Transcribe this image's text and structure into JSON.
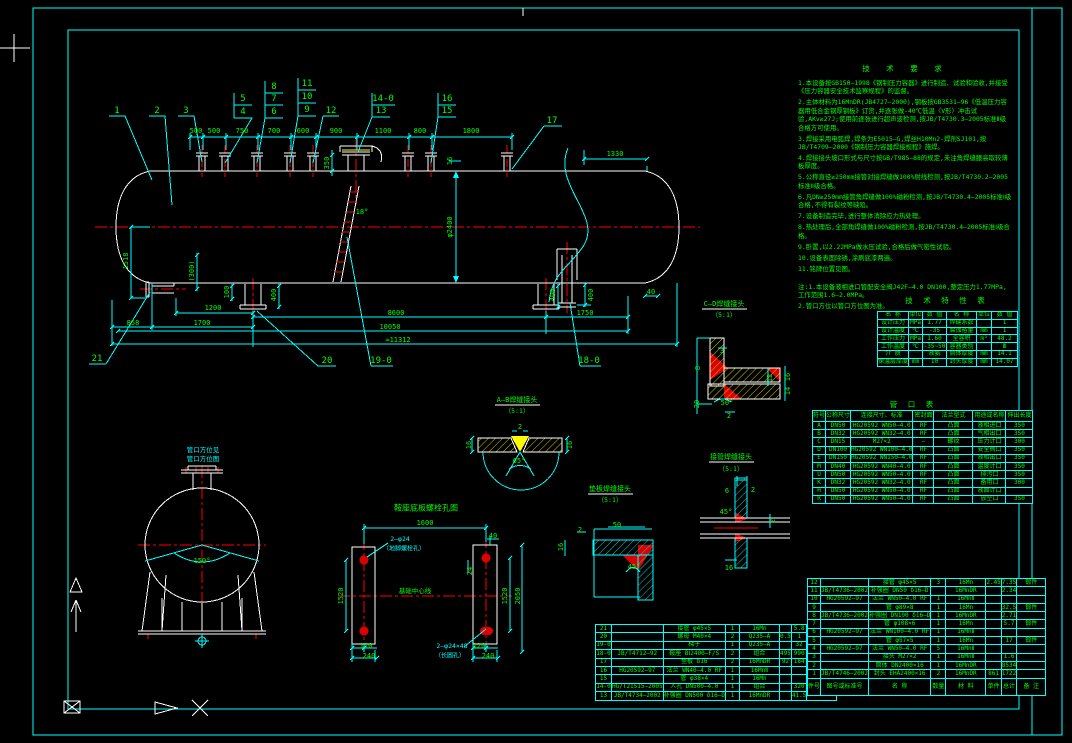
{
  "colors": {
    "background": "#000000",
    "linework": "#ffffff",
    "dims_frame": "#00ffff",
    "text": "#00ff00",
    "centerline": "#ff0000",
    "hatch": "#ffff00"
  },
  "notes": {
    "title": "技 术 要 求",
    "items": [
      "1.本设备按GB150—1998《钢制压力容器》进行制造、试验和验收,并接受《压力容器安全技术监察规程》的监督。",
      "2.主体材料为16MnDR(JB4727—2000),钢板按GB3531—96《低温压力容器用低合金钢厚钢板》订货,并逐张做-40℃低温〈V形〉冲击试验,AKv≥27J;使用前逐张进行超声波检测,按JB/T4730.3—2005标准Ⅱ级合格方可使用。",
      "3.焊接采用电弧焊,焊条为E5015—G,焊丝H10Mn2-焊剂SJ101,按JB/T4709—2000《钢制压力容器焊接规程》施焊。",
      "4.焊接接头坡口形式与尺寸按GB/T985—88的规定,未注角焊缝腰高取较薄板厚度。",
      "5.公称直径≥250mm接管对接焊缝做100%射线检测,按JB/T4730.2—2005标准Ⅱ级合格。",
      "6.凡DN≥250mm接管角焊缝做100%磁粉检测,按JB/T4730.4—2005标准Ⅰ级合格,不得有裂纹等缺陷。",
      "7.设备制造完毕,进行整体消除应力热处理。",
      "8.热处理后,全部角焊缝做100%磁粉检测,按JB/T4730.4—2005标准Ⅰ级合格。",
      "9.卧置,以2.22MPa做水压试验,合格后做气密性试验。",
      "10.设备表面除锈,涂刷底漆两遍。",
      "11.铭牌位置见图。",
      "注:1.本设备液相进口管配安全阀J42F—4.0 DN100,整定压力1.77MPa,工作范围1.6—2.0MPa。",
      "2.管口方位以管口方位图为准。"
    ]
  },
  "tech_table": {
    "title": "技 术 特 性 表",
    "headers": [
      "名 称",
      "单位",
      "数 值",
      "名 称",
      "单位",
      "数 值"
    ],
    "rows": [
      [
        "设计压力",
        "MPa",
        "1.77",
        "焊缝系数",
        "",
        "1"
      ],
      [
        "设计温度",
        "℃",
        "-35",
        "腐蚀裕量",
        "mm",
        "1"
      ],
      [
        "工作压力",
        "MPa",
        "1.60",
        "全容积",
        "m³",
        "48.2"
      ],
      [
        "工作温度",
        "℃",
        "-35~50",
        "容器类别",
        "",
        "Ⅲ"
      ],
      [
        "介 质",
        "",
        "液氨",
        "筒体厚度",
        "mm",
        "14.1"
      ],
      [
        "保温层厚度",
        "mm",
        "10",
        "封头厚度",
        "mm",
        "14.07"
      ]
    ]
  },
  "nozzle_table": {
    "title": "管 口 表",
    "headers": [
      "符号",
      "公称尺寸",
      "连接尺寸、标准",
      "密封面",
      "法兰型式",
      "用途或名称",
      "伸出长度"
    ],
    "rows": [
      [
        "A",
        "DN50",
        "HG20592 WN50—4.0",
        "RF",
        "凸面",
        "液相进口",
        "350"
      ],
      [
        "B",
        "DN32",
        "HG20592 WN32—4.0",
        "RF",
        "凸面",
        "气相出口",
        "350"
      ],
      [
        "C",
        "DN15",
        "M27×2",
        "—",
        "螺纹",
        "压力计口",
        "300"
      ],
      [
        "D",
        "DN100",
        "HG20592 WN100—4.0",
        "RF",
        "凸面",
        "安全阀口",
        "350"
      ],
      [
        "E",
        "DN150",
        "HG20592 WN150—4.0",
        "RF",
        "凸面",
        "液相出口",
        "350"
      ],
      [
        "M",
        "DN40",
        "HG20592 WN40—4.0",
        "RF",
        "凸面",
        "温度计口",
        "350"
      ],
      [
        "U",
        "DN50",
        "HG20592 WN50—4.0",
        "RF",
        "凸面",
        "排污口",
        "350"
      ],
      [
        "K",
        "DN32",
        "HG20592 WN32—4.0",
        "RF",
        "凸面",
        "备用口",
        "300"
      ],
      [
        "H",
        "DN50",
        "HG20592 WN50—4.0",
        "RF",
        "凸面",
        "液面计口",
        ""
      ],
      [
        "R",
        "DN50",
        "HG20592 WN50—4.0",
        "RF",
        "凸面",
        "放空口",
        "350"
      ]
    ]
  },
  "bom_right": {
    "headers": [
      "件号",
      "图号或标准号",
      "名 称",
      "数量",
      "材 料",
      "单件",
      "总计",
      "备 注"
    ],
    "rows": [
      [
        "12",
        "",
        "接管 φ45×5",
        "3",
        "16Mn",
        "2.45",
        "7.35",
        "锻件"
      ],
      [
        "11",
        "JB/T4736—2002",
        "补强圈 DN50 δ16—D",
        "",
        "16MnDR",
        "",
        "2.34",
        ""
      ],
      [
        "10",
        "HG20592—97",
        "法兰 WN50—4.0 RF",
        "1",
        "16MnⅡ",
        "",
        "",
        ""
      ],
      [
        "9",
        "",
        "管 φ89×8",
        "1",
        "16Mn",
        "",
        "32.5",
        "锻件"
      ],
      [
        "8",
        "JB/T4736—2002",
        "补强圈 DN100 δ16—D",
        "1",
        "16MnDR",
        "",
        "2.71",
        ""
      ],
      [
        "7",
        "",
        "管 φ108×6",
        "1",
        "16Mn",
        "",
        "5.7",
        "锻件"
      ],
      [
        "6",
        "HG20592—97",
        "法兰 WN100—4.0 RF",
        "1",
        "16MnⅡ",
        "",
        "",
        ""
      ],
      [
        "5",
        "",
        "管 φ57×5",
        "1",
        "16Mn",
        "",
        "17",
        "锻件"
      ],
      [
        "4",
        "HG20592—97",
        "法兰 WN50—4.0 RF",
        "5",
        "16MnⅡ",
        "",
        "",
        ""
      ],
      [
        "3",
        "",
        "接头 M27×2",
        "1",
        "16MnⅡ",
        "",
        "1.6",
        ""
      ],
      [
        "2",
        "",
        "筒体 DN2400×16",
        "1",
        "16MnDR",
        "",
        "8534",
        ""
      ],
      [
        "1",
        "JB/T4746—2002",
        "封头 EHA2400×16",
        "2",
        "16MnDR",
        "861",
        "1722",
        ""
      ]
    ]
  },
  "bom_left": {
    "rows": [
      [
        "21",
        "",
        "接管 φ45×5",
        "1",
        "16Mn",
        "",
        "5.8",
        "锻件"
      ],
      [
        "20",
        "",
        "螺母 M40×4",
        "2",
        "Q235—A",
        "0.5",
        "1",
        ""
      ],
      [
        "19-0",
        "",
        "梯子",
        "1",
        "Q235—A",
        "",
        "32",
        ""
      ],
      [
        "18-0",
        "JB/T4712—92",
        "鞍座 BⅠ2400—F/S",
        "2",
        "组合",
        "495",
        "990",
        "h=450"
      ],
      [
        "17",
        "",
        "垫板 δ16",
        "2",
        "16MnDR",
        "92",
        "184",
        ""
      ],
      [
        "16",
        "HG20592—97",
        "法兰 WN40—4.0 RF",
        "1",
        "16MnⅡ",
        "",
        "",
        ""
      ],
      [
        "15",
        "",
        "管 φ38×4",
        "1",
        "16Mn",
        "",
        "",
        "锻件"
      ],
      [
        "14-0",
        "HG/T21515—2005",
        "人孔 DN500—4.0",
        "1",
        "组合",
        "",
        "320",
        ""
      ],
      [
        "13",
        "JB/T4734—2002",
        "补强圈 DN500 δ16—D",
        "1",
        "16MnDR",
        "",
        "41.5",
        ""
      ]
    ]
  },
  "drawing": {
    "labels": [
      {
        "t": "1",
        "x": 117,
        "y": 111,
        "s": 9,
        "n": "balloon"
      },
      {
        "t": "2",
        "x": 157,
        "y": 111,
        "s": 9,
        "n": "balloon"
      },
      {
        "t": "3",
        "x": 186,
        "y": 111,
        "s": 9,
        "n": "balloon"
      },
      {
        "t": "5",
        "x": 243,
        "y": 99,
        "s": 9,
        "n": "balloon"
      },
      {
        "t": "4",
        "x": 243,
        "y": 112,
        "s": 9,
        "n": "balloon"
      },
      {
        "t": "8",
        "x": 274,
        "y": 87,
        "s": 9,
        "n": "balloon"
      },
      {
        "t": "7",
        "x": 274,
        "y": 99,
        "s": 9,
        "n": "balloon"
      },
      {
        "t": "6",
        "x": 274,
        "y": 112,
        "s": 9,
        "n": "balloon"
      },
      {
        "t": "11",
        "x": 307,
        "y": 84,
        "s": 9,
        "n": "balloon"
      },
      {
        "t": "10",
        "x": 307,
        "y": 97,
        "s": 9,
        "n": "balloon"
      },
      {
        "t": "9",
        "x": 307,
        "y": 110,
        "s": 9,
        "n": "balloon"
      },
      {
        "t": "12",
        "x": 331,
        "y": 111,
        "s": 9,
        "n": "balloon"
      },
      {
        "t": "14-0",
        "x": 383,
        "y": 99,
        "s": 9,
        "n": "balloon"
      },
      {
        "t": "13",
        "x": 381,
        "y": 111,
        "s": 9,
        "n": "balloon"
      },
      {
        "t": "16",
        "x": 447,
        "y": 99,
        "s": 9,
        "n": "balloon"
      },
      {
        "t": "15",
        "x": 447,
        "y": 111,
        "s": 9,
        "n": "balloon"
      },
      {
        "t": "17",
        "x": 552,
        "y": 121,
        "s": 9,
        "n": "balloon"
      },
      {
        "t": "21",
        "x": 97,
        "y": 359,
        "s": 9,
        "n": "balloon"
      },
      {
        "t": "20",
        "x": 327,
        "y": 361,
        "s": 9,
        "n": "balloon"
      },
      {
        "t": "19-0",
        "x": 381,
        "y": 361,
        "s": 9,
        "n": "balloon"
      },
      {
        "t": "18-0",
        "x": 589,
        "y": 361,
        "s": 9,
        "n": "balloon"
      },
      {
        "t": "500",
        "x": 196,
        "y": 131
      },
      {
        "t": "500",
        "x": 214,
        "y": 131
      },
      {
        "t": "750",
        "x": 242,
        "y": 131
      },
      {
        "t": "700",
        "x": 274,
        "y": 131
      },
      {
        "t": "600",
        "x": 303,
        "y": 131
      },
      {
        "t": "900",
        "x": 336,
        "y": 131
      },
      {
        "t": "1100",
        "x": 383,
        "y": 131
      },
      {
        "t": "800",
        "x": 420,
        "y": 131
      },
      {
        "t": "1800",
        "x": 471,
        "y": 131
      },
      {
        "t": "1330",
        "x": 615,
        "y": 154
      },
      {
        "t": "350",
        "x": 327,
        "y": 163,
        "r": 1
      },
      {
        "t": "16",
        "x": 450,
        "y": 161,
        "r": 1
      },
      {
        "t": "φ2400",
        "x": 450,
        "y": 227,
        "r": 1
      },
      {
        "t": "18°",
        "x": 362,
        "y": 212
      },
      {
        "t": "(300)",
        "x": 192,
        "y": 271,
        "r": 1
      },
      {
        "t": "1518",
        "x": 126,
        "y": 261,
        "r": 1
      },
      {
        "t": "100",
        "x": 227,
        "y": 292,
        "r": 1
      },
      {
        "t": "400",
        "x": 274,
        "y": 295,
        "r": 1
      },
      {
        "t": "400",
        "x": 553,
        "y": 295,
        "r": 1
      },
      {
        "t": "400",
        "x": 591,
        "y": 295,
        "r": 1
      },
      {
        "t": "40",
        "x": 651,
        "y": 292
      },
      {
        "t": "1200",
        "x": 213,
        "y": 308
      },
      {
        "t": "8600",
        "x": 396,
        "y": 313
      },
      {
        "t": "1750",
        "x": 585,
        "y": 313
      },
      {
        "t": "858",
        "x": 133,
        "y": 323
      },
      {
        "t": "1700",
        "x": 202,
        "y": 323
      },
      {
        "t": "10050",
        "x": 390,
        "y": 327
      },
      {
        "t": "≈11312",
        "x": 398,
        "y": 340
      },
      {
        "t": "150°",
        "x": 202,
        "y": 561
      },
      {
        "t": "管口方位见",
        "x": 203,
        "y": 449,
        "k": "c",
        "s": 6.5
      },
      {
        "t": "管口方位图",
        "x": 203,
        "y": 458,
        "k": "c",
        "s": 6.5
      },
      {
        "t": "鞍座底板螺栓孔图",
        "x": 426,
        "y": 508,
        "s": 8,
        "n": "detail-title"
      },
      {
        "t": "1600",
        "x": 425,
        "y": 523
      },
      {
        "t": "40",
        "x": 493,
        "y": 536
      },
      {
        "t": "24",
        "x": 470,
        "y": 571,
        "r": 1
      },
      {
        "t": "1520",
        "x": 341,
        "y": 596,
        "r": 1
      },
      {
        "t": "1520",
        "x": 505,
        "y": 596,
        "r": 1
      },
      {
        "t": "2050",
        "x": 518,
        "y": 596,
        "r": 1
      },
      {
        "t": "110",
        "x": 366,
        "y": 646
      },
      {
        "t": "240",
        "x": 369,
        "y": 656
      },
      {
        "t": "120",
        "x": 479,
        "y": 646
      },
      {
        "t": "240",
        "x": 488,
        "y": 656
      },
      {
        "t": "2—φ24",
        "x": 400,
        "y": 539,
        "k": "c",
        "s": 6.5
      },
      {
        "t": "（地脚螺栓孔）",
        "x": 404,
        "y": 548,
        "k": "c",
        "s": 6
      },
      {
        "t": "2—φ24×48",
        "x": 452,
        "y": 646,
        "k": "c",
        "s": 6.5
      },
      {
        "t": "（长圆孔）",
        "x": 450,
        "y": 655,
        "k": "c",
        "s": 6
      },
      {
        "t": "基础中心线",
        "x": 415,
        "y": 590,
        "s": 6.5
      },
      {
        "t": "A—B焊缝接头",
        "x": 517,
        "y": 400,
        "s": 7,
        "n": "detail-title"
      },
      {
        "t": "（5:1）",
        "x": 517,
        "y": 410,
        "s": 6.5
      },
      {
        "t": "2",
        "x": 520,
        "y": 427
      },
      {
        "t": "16",
        "x": 469,
        "y": 445,
        "r": 1
      },
      {
        "t": "16",
        "x": 570,
        "y": 445,
        "r": 1
      },
      {
        "t": "65°",
        "x": 519,
        "y": 461
      },
      {
        "t": "C—D焊缝接头",
        "x": 724,
        "y": 304,
        "s": 7,
        "n": "detail-title"
      },
      {
        "t": "（5:1）",
        "x": 724,
        "y": 314,
        "s": 6.5
      },
      {
        "t": "3",
        "x": 722,
        "y": 351
      },
      {
        "t": "8",
        "x": 698,
        "y": 368,
        "r": 1
      },
      {
        "t": "12",
        "x": 770,
        "y": 378,
        "r": 1
      },
      {
        "t": "16",
        "x": 788,
        "y": 377,
        "r": 1
      },
      {
        "t": "14",
        "x": 788,
        "y": 391,
        "r": 1
      },
      {
        "t": "20",
        "x": 697,
        "y": 404,
        "r": 1
      },
      {
        "t": "50°",
        "x": 727,
        "y": 403
      },
      {
        "t": "2",
        "x": 729,
        "y": 416
      },
      {
        "t": "垫板焊缝接头",
        "x": 610,
        "y": 489,
        "s": 7,
        "n": "detail-title"
      },
      {
        "t": "（5:1）",
        "x": 610,
        "y": 499,
        "s": 6.5
      },
      {
        "t": "2",
        "x": 580,
        "y": 530
      },
      {
        "t": "16",
        "x": 561,
        "y": 547,
        "r": 1
      },
      {
        "t": "50",
        "x": 617,
        "y": 525
      },
      {
        "t": "45°",
        "x": 634,
        "y": 567
      },
      {
        "t": "接管焊缝接头",
        "x": 731,
        "y": 457,
        "s": 7,
        "n": "detail-title"
      },
      {
        "t": "（5:1）",
        "x": 731,
        "y": 468,
        "s": 6.5
      },
      {
        "t": "6",
        "x": 727,
        "y": 491
      },
      {
        "t": "2",
        "x": 753,
        "y": 490
      },
      {
        "t": "45°",
        "x": 726,
        "y": 512
      },
      {
        "t": "16",
        "x": 729,
        "y": 568
      },
      {
        "t": "2",
        "x": 773,
        "y": 521,
        "r": 1
      }
    ]
  }
}
